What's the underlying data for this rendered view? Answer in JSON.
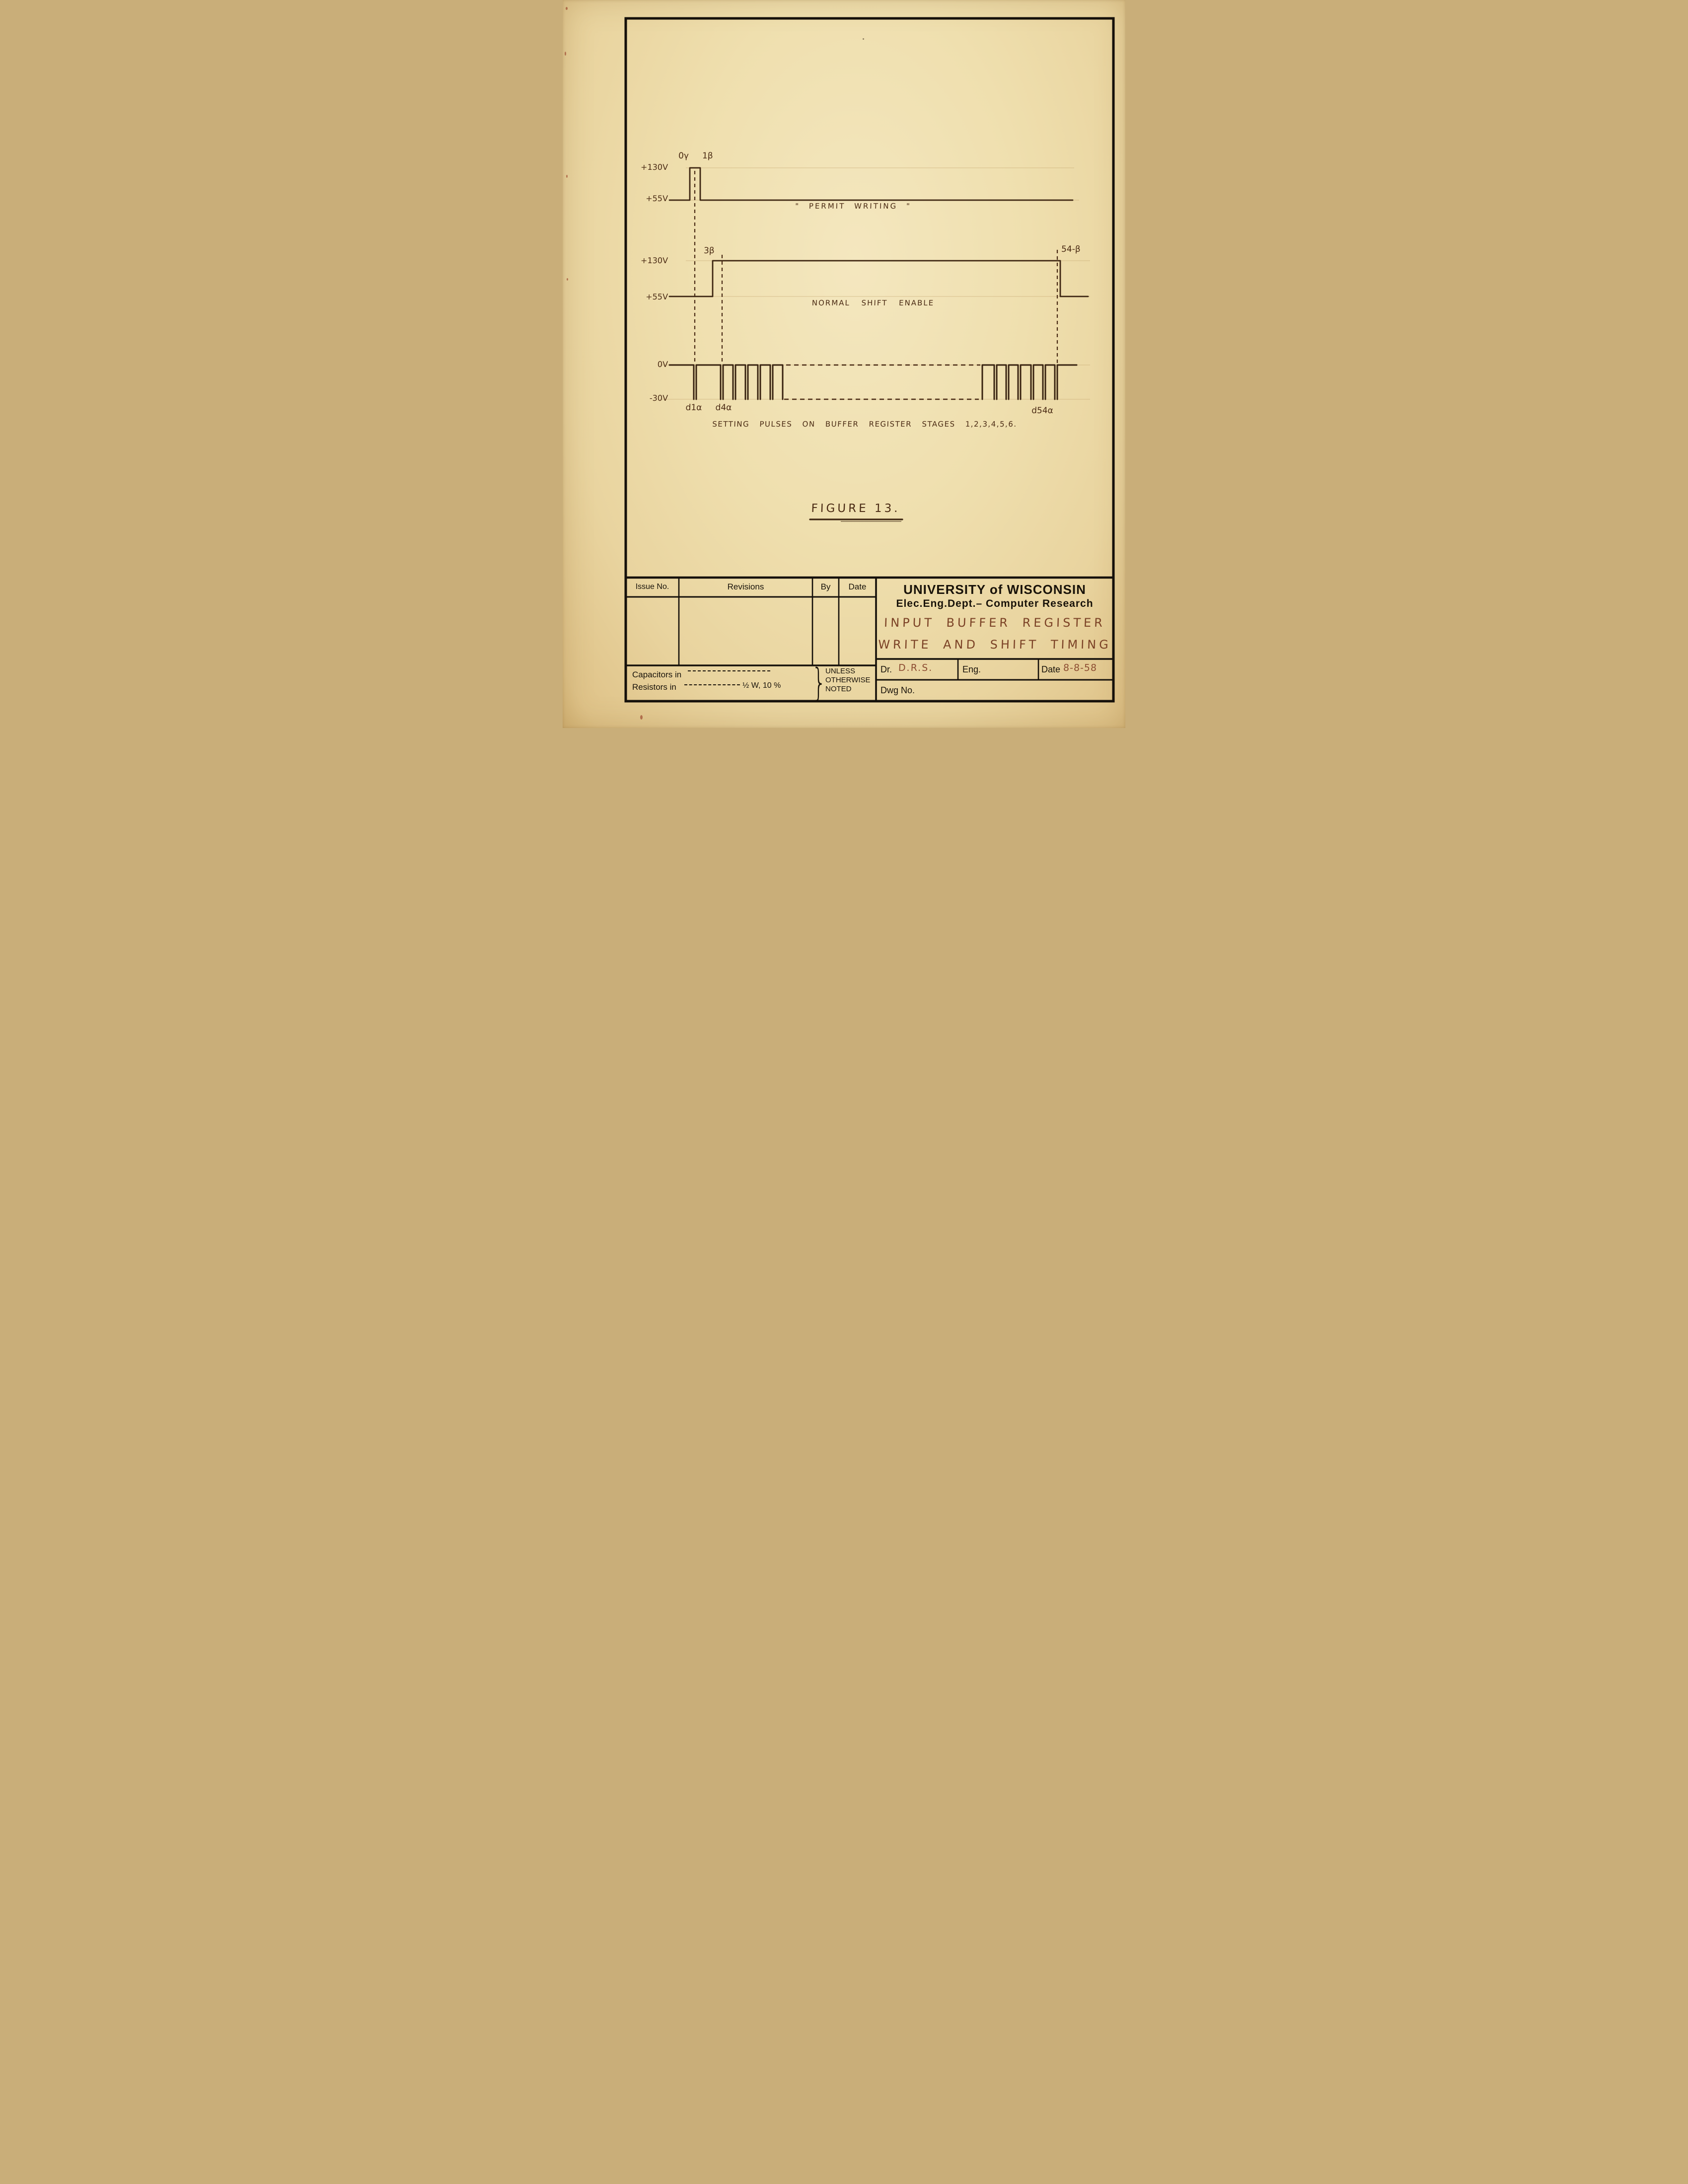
{
  "figure_label": "FIGURE 13.",
  "waveform_permit_writing": {
    "high_label": "+130V",
    "low_label": "+55V",
    "gamma_label": "0γ",
    "beta_label": "1β",
    "caption": "\" PERMIT WRITING \""
  },
  "waveform_shift_enable": {
    "high_label": "+130V",
    "low_label": "+55V",
    "rise_label": "3β",
    "fall_label": "54-β",
    "caption": "NORMAL SHIFT ENABLE"
  },
  "waveform_setting_pulses": {
    "high_label": "0V",
    "low_label": "-30V",
    "d1_label": "d1α",
    "d4_label": "d4α",
    "d54_label": "d54α",
    "caption": "SETTING PULSES ON BUFFER REGISTER STAGES 1,2,3,4,5,6."
  },
  "title_block": {
    "issue_no_header": "Issue No.",
    "revisions_header": "Revisions",
    "by_header": "By",
    "date_header": "Date",
    "university": "UNIVERSITY of WISCONSIN",
    "department": "Elec.Eng.Dept.– Computer Research",
    "drawing_title_line1": "INPUT BUFFER REGISTER",
    "drawing_title_line2": "WRITE AND SHIFT TIMING",
    "dr_label": "Dr.",
    "dr_value": "D.R.S.",
    "eng_label": "Eng.",
    "date_label": "Date",
    "date_value": "8-8-58",
    "dwg_label": "Dwg No.",
    "capacitors_note": "Capacitors in",
    "resistors_note": "Resistors in",
    "resistors_value": "½ W, 10 %",
    "brace": "}",
    "note_line1": "UNLESS",
    "note_line2": "OTHERWISE",
    "note_line3": "NOTED"
  }
}
